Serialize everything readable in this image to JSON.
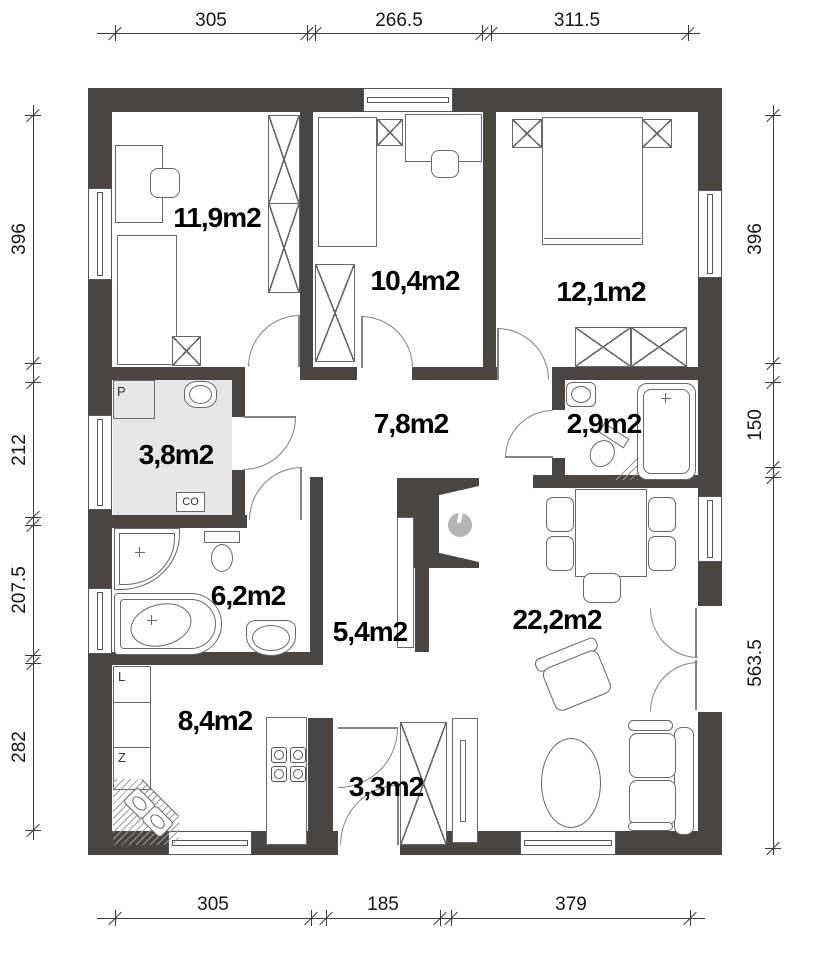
{
  "plan": {
    "rooms": [
      {
        "id": "bedroom-1",
        "label": "11,9m2"
      },
      {
        "id": "bedroom-2",
        "label": "10,4m2"
      },
      {
        "id": "bedroom-3",
        "label": "12,1m2"
      },
      {
        "id": "hall",
        "label": "7,8m2"
      },
      {
        "id": "wc",
        "label": "2,9m2"
      },
      {
        "id": "utility",
        "label": "3,8m2"
      },
      {
        "id": "bathroom",
        "label": "6,2m2"
      },
      {
        "id": "corridor",
        "label": "5,4m2"
      },
      {
        "id": "living-room",
        "label": "22,2m2"
      },
      {
        "id": "kitchen",
        "label": "8,4m2"
      },
      {
        "id": "entry",
        "label": "3,3m2"
      }
    ],
    "appliance_labels": {
      "p": "P",
      "co": "CO",
      "l": "L",
      "z": "Z"
    },
    "dimensions": {
      "top": [
        "305",
        "266.5",
        "311.5"
      ],
      "bottom": [
        "305",
        "185",
        "379"
      ],
      "left": [
        "396",
        "212",
        "207.5",
        "282"
      ],
      "right": [
        "396",
        "150",
        "563.5"
      ]
    },
    "colors": {
      "wall": "#494542",
      "utility_floor": "#e6e6e6",
      "fireplace_dot": "#b5b5b5"
    }
  }
}
